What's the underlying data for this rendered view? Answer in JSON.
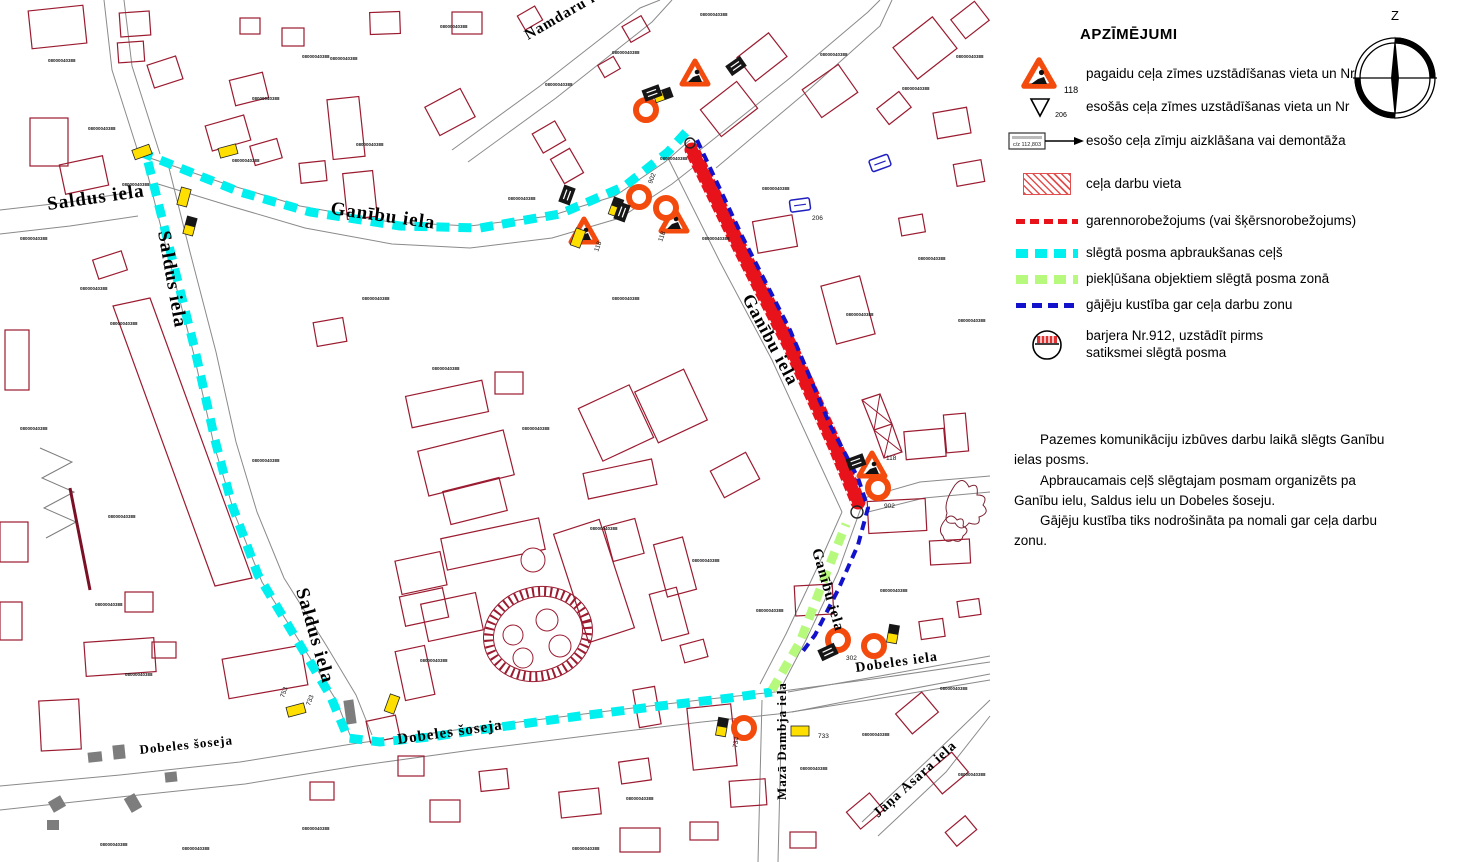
{
  "legend": {
    "title": "APZĪMĒJUMI",
    "items": [
      {
        "icon": "temp-roadworks-sign",
        "number": "118",
        "label": "pagaidu ceļa zīmes uzstādīšanas vieta un Nr"
      },
      {
        "icon": "existing-sign",
        "number": "206",
        "label": "esošās ceļa zīmes uzstādīšanas vieta un Nr"
      },
      {
        "icon": "covered-sign",
        "sign_text": "c/z 112,803",
        "label": "esošo ceļa zīmju aizklāšana vai demontāža"
      },
      {
        "icon": "work-area",
        "label": "ceļa darbu vieta"
      },
      {
        "icon": "red-dash",
        "label": "garennorobežojums (vai šķērsnorobežojums)"
      },
      {
        "icon": "cyan-dash",
        "label": "slēgtā posma apbraukšanas ceļš"
      },
      {
        "icon": "green-dash",
        "label": "piekļūšana objektiem slēgtā posma zonā"
      },
      {
        "icon": "blue-dash",
        "label": "gājēju kustība gar ceļa darbu zonu"
      },
      {
        "icon": "barrier-circle",
        "label": "barjera Nr.912, uzstādīt pirms\nsatiksmei slēgtā posma"
      }
    ]
  },
  "compass": {
    "north_label": "Z"
  },
  "notes": [
    "Pazemes komunikāciju izbūves darbu laikā slēgts Ganību ielas posms.",
    "Apbraucamais ceļš slēgtajam posmam organizēts pa Ganību ielu, Saldus ielu un Dobeles šoseju.",
    "Gājēju kustība tiks nodrošināta pa nomali gar ceļa darbu zonu."
  ],
  "map": {
    "palette": {
      "street": "#8a8a8a",
      "building": "#9b1b30",
      "detour": "#00efef",
      "access": "#b7f97d",
      "pedestrian": "#1212cc",
      "work": "#e8121b",
      "orange": "#f34a0e",
      "sign_yellow": "#ffdf00"
    },
    "streets": [
      "150,158 220,182 300,206 390,222 470,226 550,216 615,196 665,162 690,140",
      "158,184 230,206 305,228 392,244 470,248 552,238 620,218 672,184 700,162",
      "0,210 70,202 132,192",
      "0,234 70,226 138,216",
      "146,168 168,255 194,355 214,445 235,515 262,582 305,650 336,700 352,740",
      "168,164 190,252 216,352 236,442 257,512 284,578 326,645 356,695 372,735",
      "0,786 120,775 240,762 352,744 470,728 600,712 700,700 775,692 880,678 990,662",
      "0,810 120,797 245,784 356,766 472,750 602,734 702,722 778,714 882,698 990,680",
      "688,148 740,250 792,350 838,452 862,505",
      "668,158 720,262 772,360 818,460 842,512",
      "862,505 838,572 806,640 780,690",
      "842,512 818,566 786,634 760,684",
      "788,692 880,676 990,656",
      "792,712 884,694 990,674",
      "762,700 758,862",
      "782,698 778,862",
      "862,822 930,758 990,700",
      "878,836 946,772 990,716",
      "452,150 540,86 640,8 660,0",
      "468,162 556,98 652,22 672,0",
      "700,150 790,78 868,12 880,0",
      "716,168 804,94 880,26 892,0",
      "140,158 112,70 104,0",
      "160,154 132,66 124,0",
      "864,498 920,482 990,476",
      "868,512 924,498 990,492"
    ],
    "extra_paths": [
      {
        "d": "M40,448 L72,462 L42,478 L74,492 L44,508 L76,522 L46,538",
        "s": "#7d7d7d",
        "w": 1,
        "n": "fence-zigzag"
      },
      {
        "d": "M70,488 L90,590",
        "s": "#7a1025",
        "w": 3,
        "n": "wall-line"
      },
      {
        "d": "M862,400 L880,394 L892,424 L874,430 Z M874,430 L892,424 L902,452 L884,458 Z",
        "s": "#9b1b30",
        "w": 1.2,
        "n": "mast-tower"
      },
      {
        "d": "M862,400 L892,424 M880,394 L874,430 M874,430 L902,452 M892,424 L884,458",
        "s": "#9b1b30",
        "w": 1,
        "n": "mast-bracing"
      },
      {
        "d": "M955,485 q8,-10 14,2 q10,-6 8,8 q12,0 6,10 q8,8 -4,12 q2,10 -10,6 q-8,10 -14,0 q-12,2 -8,-10 q-4,-10 8,-28",
        "s": "#7a2030",
        "w": 1,
        "n": "vegetation-scribble"
      },
      {
        "d": "M945,520 q6,-8 12,0 q8,-4 6,6 q8,4 0,10 q-2,8 -10,4 q-8,4 -10,-4 q-6,-6 2,-16",
        "s": "#7a2030",
        "w": 1,
        "n": "vegetation-scribble"
      },
      {
        "d": "M113,306 L150,298 L252,578 L215,586 Z",
        "s": "#9b1b30",
        "w": 1.2,
        "n": "long-building-strip"
      }
    ],
    "buildings": [
      [
        30,
        8,
        55,
        38,
        -6
      ],
      [
        120,
        12,
        30,
        24,
        -4
      ],
      [
        118,
        42,
        26,
        20,
        -4
      ],
      [
        150,
        60,
        30,
        24,
        -18
      ],
      [
        232,
        76,
        34,
        26,
        -14
      ],
      [
        282,
        28,
        22,
        18,
        0
      ],
      [
        240,
        18,
        20,
        16,
        0
      ],
      [
        370,
        12,
        30,
        22,
        -2
      ],
      [
        30,
        118,
        38,
        48,
        0
      ],
      [
        62,
        160,
        44,
        30,
        -12
      ],
      [
        208,
        120,
        40,
        26,
        -16
      ],
      [
        252,
        142,
        28,
        20,
        -16
      ],
      [
        330,
        98,
        32,
        60,
        -6
      ],
      [
        300,
        162,
        26,
        20,
        -6
      ],
      [
        345,
        172,
        30,
        46,
        -6
      ],
      [
        430,
        96,
        40,
        32,
        -28
      ],
      [
        452,
        12,
        30,
        22,
        0
      ],
      [
        520,
        10,
        20,
        16,
        -30
      ],
      [
        536,
        126,
        26,
        22,
        -30
      ],
      [
        556,
        152,
        22,
        28,
        -30
      ],
      [
        600,
        60,
        18,
        14,
        -30
      ],
      [
        625,
        20,
        22,
        18,
        -30
      ],
      [
        742,
        42,
        40,
        30,
        -38
      ],
      [
        706,
        92,
        46,
        34,
        -38
      ],
      [
        808,
        74,
        44,
        34,
        -35
      ],
      [
        900,
        28,
        50,
        40,
        -38
      ],
      [
        955,
        8,
        30,
        24,
        -38
      ],
      [
        880,
        98,
        28,
        20,
        -38
      ],
      [
        935,
        110,
        34,
        26,
        -10
      ],
      [
        955,
        162,
        28,
        22,
        -10
      ],
      [
        755,
        218,
        40,
        32,
        -10
      ],
      [
        828,
        280,
        40,
        60,
        -15
      ],
      [
        900,
        216,
        24,
        18,
        -10
      ],
      [
        95,
        255,
        30,
        20,
        -18
      ],
      [
        5,
        330,
        24,
        60,
        0
      ],
      [
        0,
        522,
        28,
        40,
        0
      ],
      [
        315,
        320,
        30,
        24,
        -10
      ],
      [
        408,
        388,
        78,
        32,
        -12
      ],
      [
        422,
        440,
        88,
        46,
        -14
      ],
      [
        446,
        484,
        58,
        34,
        -14
      ],
      [
        495,
        372,
        28,
        22,
        0
      ],
      [
        588,
        394,
        56,
        58,
        -25
      ],
      [
        644,
        378,
        54,
        56,
        -25
      ],
      [
        585,
        466,
        70,
        26,
        -12
      ],
      [
        443,
        528,
        100,
        32,
        -12
      ],
      [
        398,
        556,
        46,
        34,
        -12
      ],
      [
        402,
        592,
        44,
        30,
        -12
      ],
      [
        424,
        598,
        56,
        38,
        -12
      ],
      [
        570,
        524,
        48,
        114,
        -18
      ],
      [
        608,
        522,
        32,
        36,
        -15
      ],
      [
        660,
        540,
        30,
        54,
        -15
      ],
      [
        715,
        460,
        40,
        30,
        -28
      ],
      [
        400,
        648,
        30,
        50,
        -12
      ],
      [
        368,
        718,
        30,
        22,
        -12
      ],
      [
        398,
        756,
        26,
        20,
        0
      ],
      [
        310,
        782,
        24,
        18,
        0
      ],
      [
        430,
        800,
        30,
        22,
        0
      ],
      [
        480,
        770,
        28,
        20,
        -6
      ],
      [
        560,
        790,
        40,
        26,
        -6
      ],
      [
        620,
        760,
        30,
        22,
        -8
      ],
      [
        655,
        590,
        28,
        48,
        -15
      ],
      [
        682,
        642,
        24,
        18,
        -15
      ],
      [
        636,
        688,
        22,
        38,
        -10
      ],
      [
        690,
        706,
        44,
        62,
        -6
      ],
      [
        730,
        780,
        36,
        26,
        -4
      ],
      [
        620,
        828,
        40,
        24,
        0
      ],
      [
        690,
        822,
        28,
        18,
        0
      ],
      [
        85,
        640,
        70,
        34,
        -4
      ],
      [
        40,
        700,
        40,
        50,
        -3
      ],
      [
        125,
        592,
        28,
        20,
        0
      ],
      [
        152,
        642,
        24,
        16,
        0
      ],
      [
        225,
        652,
        80,
        40,
        -10
      ],
      [
        0,
        602,
        22,
        38,
        0
      ],
      [
        900,
        700,
        34,
        26,
        -40
      ],
      [
        930,
        760,
        34,
        26,
        -40
      ],
      [
        850,
        800,
        30,
        22,
        -40
      ],
      [
        790,
        832,
        26,
        16,
        0
      ],
      [
        948,
        822,
        26,
        18,
        -40
      ],
      [
        920,
        620,
        24,
        18,
        -8
      ],
      [
        958,
        600,
        22,
        16,
        -8
      ],
      [
        905,
        430,
        40,
        28,
        -5
      ],
      [
        945,
        414,
        22,
        38,
        -5
      ],
      [
        868,
        500,
        58,
        32,
        -3
      ],
      [
        930,
        540,
        40,
        24,
        -3
      ],
      [
        795,
        585,
        38,
        30,
        -3
      ]
    ],
    "gray_structures": [
      [
        113,
        745,
        12,
        14,
        -6
      ],
      [
        88,
        752,
        14,
        10,
        -6
      ],
      [
        165,
        772,
        12,
        10,
        -6
      ],
      [
        127,
        795,
        12,
        16,
        -30
      ],
      [
        50,
        798,
        14,
        12,
        -30
      ],
      [
        47,
        820,
        12,
        10,
        0
      ],
      [
        345,
        700,
        10,
        24,
        -8
      ]
    ],
    "tanks": {
      "cx": 538,
      "cy": 634,
      "rx": 50,
      "ry": 42,
      "rot": -15,
      "circles": [
        [
          513,
          635,
          10
        ],
        [
          547,
          620,
          11
        ],
        [
          560,
          646,
          11
        ],
        [
          523,
          658,
          10
        ],
        [
          533,
          560,
          12
        ]
      ]
    },
    "routes": {
      "detour_north": "140,152 180,168 240,192 310,212 400,226 480,228 560,214 625,186 668,152 688,130",
      "detour_west": "148,162 170,250 195,350 215,440 232,505 258,575 300,645 330,695 348,738 380,742 430,737 500,727 580,716 660,706 730,698 772,692",
      "access": "772,690 800,642 826,574 846,524",
      "pedestrian": "697,140 712,172 742,236 790,330 830,425 858,478 868,508 858,545 838,590 815,635 800,655",
      "work_zone": "692,150 740,248 790,346 836,448 858,502"
    },
    "signs": {
      "triangles": [
        [
          695,
          74
        ],
        [
          584,
          232
        ],
        [
          674,
          221
        ],
        [
          872,
          466
        ]
      ],
      "rings": [
        [
          646,
          110
        ],
        [
          639,
          197
        ],
        [
          666,
          208
        ],
        [
          878,
          488
        ],
        [
          838,
          640
        ],
        [
          874,
          646
        ],
        [
          744,
          728
        ]
      ],
      "ysigns": [
        [
          142,
          152,
          -20,
          0
        ],
        [
          228,
          151,
          -15,
          0
        ],
        [
          184,
          197,
          -75,
          0
        ],
        [
          190,
          226,
          -75,
          1
        ],
        [
          663,
          95,
          -20,
          1
        ],
        [
          616,
          207,
          -70,
          1
        ],
        [
          578,
          238,
          -70,
          0
        ],
        [
          893,
          634,
          -80,
          1
        ],
        [
          800,
          731,
          0,
          0
        ],
        [
          722,
          727,
          -80,
          1
        ],
        [
          296,
          710,
          -15,
          0
        ],
        [
          392,
          704,
          -70,
          0
        ]
      ],
      "bsigns": [
        [
          652,
          93,
          -20
        ],
        [
          622,
          212,
          -70
        ],
        [
          828,
          652,
          -25
        ],
        [
          736,
          66,
          -35
        ],
        [
          567,
          195,
          -70
        ],
        [
          856,
          462,
          -20
        ]
      ],
      "bluesigns": [
        [
          800,
          205,
          -8
        ],
        [
          880,
          163,
          -20
        ]
      ]
    },
    "sign_numbers": [
      [
        "118",
        598,
        252,
        -70
      ],
      [
        "118",
        662,
        242,
        -70
      ],
      [
        "118",
        886,
        460,
        0
      ],
      [
        "902",
        652,
        184,
        -70
      ],
      [
        "902",
        884,
        508,
        0
      ],
      [
        "302",
        846,
        660,
        0
      ],
      [
        "733",
        818,
        738,
        0
      ],
      [
        "733",
        310,
        706,
        -70
      ],
      [
        "734",
        737,
        748,
        -80
      ],
      [
        "753",
        284,
        698,
        -70
      ],
      [
        "206",
        812,
        220,
        0
      ]
    ],
    "street_labels": [
      {
        "t": "Saldus iela",
        "x": 48,
        "y": 210,
        "r": -8,
        "s": 19
      },
      {
        "t": "Saldus iela",
        "x": 158,
        "y": 232,
        "r": 80,
        "s": 19
      },
      {
        "t": "Saldus iela",
        "x": 296,
        "y": 590,
        "r": 74,
        "s": 19
      },
      {
        "t": "Ganību iela",
        "x": 330,
        "y": 214,
        "r": 8,
        "s": 19
      },
      {
        "t": "Ganību iela",
        "x": 742,
        "y": 298,
        "r": 62,
        "s": 18
      },
      {
        "t": "Ganību iela",
        "x": 812,
        "y": 550,
        "r": 74,
        "s": 15
      },
      {
        "t": "Namdaru iela",
        "x": 528,
        "y": 40,
        "r": -30,
        "s": 15
      },
      {
        "t": "Dobeles šoseja",
        "x": 140,
        "y": 754,
        "r": -6,
        "s": 13
      },
      {
        "t": "Dobeles šoseja",
        "x": 398,
        "y": 744,
        "r": -8,
        "s": 15
      },
      {
        "t": "Dobeles iela",
        "x": 856,
        "y": 672,
        "r": -8,
        "s": 14
      },
      {
        "t": "Mazā Dambja iela",
        "x": 786,
        "y": 800,
        "r": -90,
        "s": 13
      },
      {
        "t": "Jāņa Asara iela",
        "x": 878,
        "y": 818,
        "r": -42,
        "s": 14
      }
    ],
    "parcel_code": "08000040388",
    "parcel_marks": [
      [
        88,
        130
      ],
      [
        122,
        186
      ],
      [
        252,
        100
      ],
      [
        302,
        58
      ],
      [
        232,
        162
      ],
      [
        356,
        146
      ],
      [
        440,
        28
      ],
      [
        545,
        86
      ],
      [
        612,
        54
      ],
      [
        700,
        16
      ],
      [
        820,
        56
      ],
      [
        902,
        90
      ],
      [
        956,
        58
      ],
      [
        80,
        290
      ],
      [
        110,
        325
      ],
      [
        108,
        518
      ],
      [
        95,
        606
      ],
      [
        125,
        676
      ],
      [
        252,
        462
      ],
      [
        362,
        300
      ],
      [
        432,
        370
      ],
      [
        522,
        430
      ],
      [
        612,
        300
      ],
      [
        702,
        240
      ],
      [
        762,
        190
      ],
      [
        846,
        316
      ],
      [
        918,
        260
      ],
      [
        958,
        322
      ],
      [
        590,
        530
      ],
      [
        692,
        562
      ],
      [
        756,
        612
      ],
      [
        880,
        592
      ],
      [
        940,
        690
      ],
      [
        800,
        770
      ],
      [
        626,
        800
      ],
      [
        572,
        850
      ],
      [
        302,
        830
      ],
      [
        182,
        850
      ],
      [
        100,
        846
      ],
      [
        48,
        62
      ],
      [
        20,
        240
      ],
      [
        20,
        430
      ],
      [
        958,
        776
      ],
      [
        862,
        736
      ],
      [
        660,
        160
      ],
      [
        508,
        200
      ],
      [
        420,
        662
      ],
      [
        330,
        60
      ]
    ]
  }
}
